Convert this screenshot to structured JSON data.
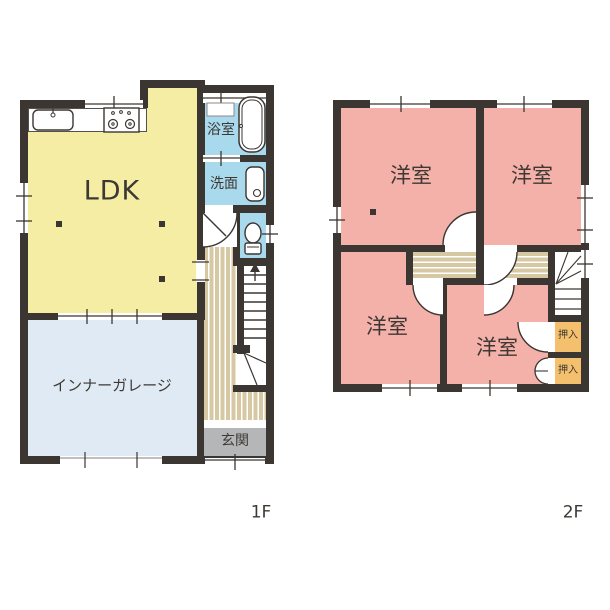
{
  "floor1": {
    "label": "1F",
    "ldk": "LDK",
    "garage": "インナーガレージ",
    "bathroom": "浴室",
    "washroom": "洗面",
    "entrance": "玄関"
  },
  "floor2": {
    "label": "2F",
    "bedroom_top_left": "洋室",
    "bedroom_top_right": "洋室",
    "bedroom_bottom_left": "洋室",
    "bedroom_bottom_center": "洋室",
    "closet_top": "押入",
    "closet_bottom": "押入"
  },
  "colors": {
    "wall": "#3b3632",
    "ldk_yellow": "#f4eda3",
    "garage_blue": "#dfeaf5",
    "wet_area_blue": "#a9d9ec",
    "bedroom_pink": "#f4b1a9",
    "hallway_beige": "#d5c8a2",
    "closet_orange": "#f4c06e",
    "entrance_gray": "#b5b6b8"
  },
  "fixtures": [
    "kitchen-sink-icon",
    "gas-stove-icon",
    "bathtub-icon",
    "vanity-counter",
    "washbasin-icon",
    "toilet-icon",
    "stairs-up-arrow-icon",
    "pillar-marker"
  ]
}
